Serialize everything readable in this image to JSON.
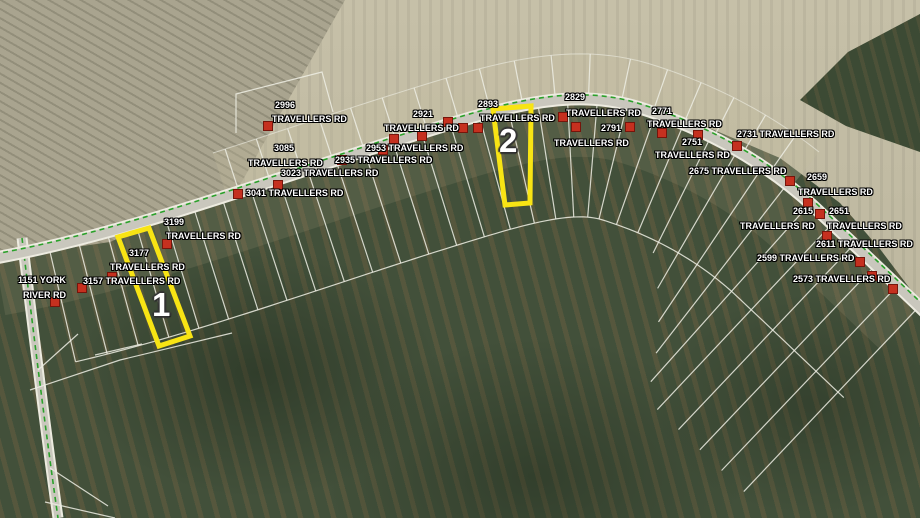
{
  "map": {
    "type": "aerial-parcel-map",
    "road_names": [
      "TRAVELLERS RD",
      "YORK RIVER RD"
    ],
    "highlighted_parcels": [
      {
        "number": "1",
        "x": 152,
        "y": 288
      },
      {
        "number": "2",
        "x": 499,
        "y": 124
      }
    ],
    "address_labels": [
      {
        "text": "2996",
        "x": 275,
        "y": 100
      },
      {
        "text": "TRAVELLERS RD",
        "x": 272,
        "y": 114
      },
      {
        "text": "3085",
        "x": 274,
        "y": 143
      },
      {
        "text": "TRAVELLERS RD",
        "x": 248,
        "y": 158
      },
      {
        "text": "3023 TRAVELLERS RD",
        "x": 281,
        "y": 168
      },
      {
        "text": "3041 TRAVELLERS RD",
        "x": 246,
        "y": 188
      },
      {
        "text": "2953 TRAVELLERS RD",
        "x": 366,
        "y": 143
      },
      {
        "text": "2935 TRAVELLERS RD",
        "x": 335,
        "y": 155
      },
      {
        "text": "2921",
        "x": 413,
        "y": 109
      },
      {
        "text": "TRAVELLERS RD",
        "x": 384,
        "y": 123
      },
      {
        "text": "2893",
        "x": 478,
        "y": 99
      },
      {
        "text": "TRAVELLERS RD",
        "x": 480,
        "y": 113
      },
      {
        "text": "2829",
        "x": 565,
        "y": 92
      },
      {
        "text": "TRAVELLERS RD",
        "x": 566,
        "y": 108
      },
      {
        "text": "2791",
        "x": 601,
        "y": 123
      },
      {
        "text": "TRAVELLERS RD",
        "x": 554,
        "y": 138
      },
      {
        "text": "2771",
        "x": 652,
        "y": 106
      },
      {
        "text": "TRAVELLERS RD",
        "x": 647,
        "y": 119
      },
      {
        "text": "2751",
        "x": 682,
        "y": 137
      },
      {
        "text": "TRAVELLERS RD",
        "x": 655,
        "y": 150
      },
      {
        "text": "2731 TRAVELLERS RD",
        "x": 737,
        "y": 129
      },
      {
        "text": "2675 TRAVELLERS RD",
        "x": 689,
        "y": 166
      },
      {
        "text": "2659",
        "x": 807,
        "y": 172
      },
      {
        "text": "TRAVELLERS RD",
        "x": 798,
        "y": 187
      },
      {
        "text": "2615",
        "x": 793,
        "y": 206
      },
      {
        "text": "TRAVELLERS RD",
        "x": 740,
        "y": 221
      },
      {
        "text": "2651",
        "x": 829,
        "y": 206
      },
      {
        "text": "TRAVELLERS RD",
        "x": 827,
        "y": 221
      },
      {
        "text": "2611 TRAVELLERS RD",
        "x": 816,
        "y": 239
      },
      {
        "text": "2599 TRAVELLERS RD",
        "x": 757,
        "y": 253
      },
      {
        "text": "2573 TRAVELLERS RD",
        "x": 793,
        "y": 274
      },
      {
        "text": "3199",
        "x": 164,
        "y": 217
      },
      {
        "text": "TRAVELLERS RD",
        "x": 166,
        "y": 231
      },
      {
        "text": "3177",
        "x": 129,
        "y": 248
      },
      {
        "text": "TRAVELLERS RD",
        "x": 110,
        "y": 262
      },
      {
        "text": "3157 TRAVELLERS RD",
        "x": 83,
        "y": 276
      },
      {
        "text": "1151 YORK",
        "x": 18,
        "y": 275
      },
      {
        "text": "RIVER RD",
        "x": 23,
        "y": 290
      }
    ],
    "structure_markers": [
      [
        268,
        126
      ],
      [
        342,
        160
      ],
      [
        394,
        139
      ],
      [
        422,
        136
      ],
      [
        448,
        122
      ],
      [
        478,
        128
      ],
      [
        463,
        128
      ],
      [
        563,
        117
      ],
      [
        576,
        127
      ],
      [
        630,
        127
      ],
      [
        662,
        133
      ],
      [
        698,
        135
      ],
      [
        737,
        146
      ],
      [
        790,
        181
      ],
      [
        808,
        203
      ],
      [
        820,
        214
      ],
      [
        827,
        236
      ],
      [
        860,
        262
      ],
      [
        872,
        276
      ],
      [
        893,
        289
      ],
      [
        167,
        244
      ],
      [
        112,
        277
      ],
      [
        82,
        288
      ],
      [
        55,
        302
      ],
      [
        278,
        185
      ],
      [
        238,
        194
      ],
      [
        383,
        150
      ]
    ],
    "colors": {
      "field": "#bcb69e",
      "field_left": "#a9a48f",
      "forest": "#42503a",
      "forest_rows": "#766342",
      "road": "#c9c7bd",
      "road_casing": "#edebe0",
      "route_line": "#2aa12a",
      "parcel_line": "#eeeee4",
      "marker": "#c5301f",
      "highlight": "#f8e414",
      "label_text": "#ffffff"
    }
  }
}
